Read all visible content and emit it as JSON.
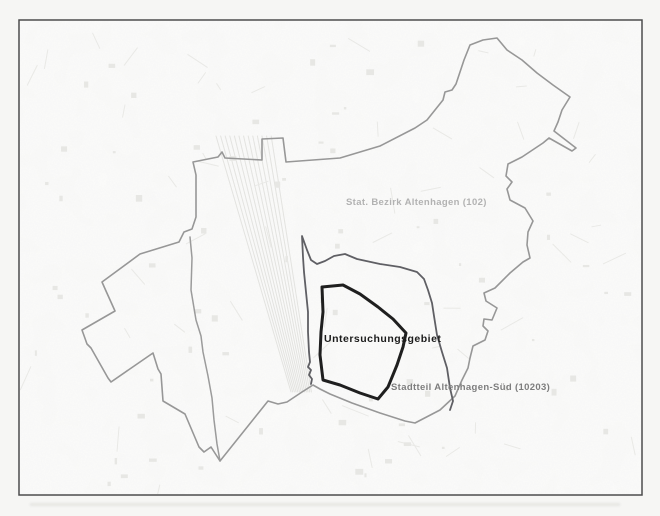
{
  "map": {
    "title": "Untersuchungsgebiet Altenhagen boundary map",
    "labels": {
      "bezirk": {
        "text": "Stat. Bezirk Altenhagen (102)",
        "color": "#b2b2b2"
      },
      "untersuchungsgebiet": {
        "text": "Untersuchungsgebiet",
        "color": "#1b1b1b"
      },
      "stadtteil": {
        "text": "Stadtteil Altenhagen-Süd (10203)",
        "color": "#7d7d7d"
      }
    },
    "frame": {
      "x": 19,
      "y": 20,
      "width": 623,
      "height": 475,
      "stroke": "#4c4c4c",
      "fill": "#fcfcfb"
    },
    "boundaries": [
      {
        "name": "boundary-stat-bezirk-altenhagen-102",
        "color": "#979797",
        "width": 1.6,
        "closed": true,
        "points": [
          [
            193,
            162
          ],
          [
            196,
            175
          ],
          [
            196,
            217
          ],
          [
            192,
            229
          ],
          [
            184,
            232
          ],
          [
            179,
            242
          ],
          [
            140,
            254
          ],
          [
            102,
            282
          ],
          [
            106,
            291
          ],
          [
            115,
            311
          ],
          [
            82,
            330
          ],
          [
            87,
            344
          ],
          [
            91,
            348
          ],
          [
            108,
            378
          ],
          [
            111,
            382
          ],
          [
            153,
            353
          ],
          [
            158,
            369
          ],
          [
            161,
            374
          ],
          [
            163,
            401
          ],
          [
            185,
            414
          ],
          [
            199,
            447
          ],
          [
            204,
            452
          ],
          [
            211,
            447
          ],
          [
            220,
            461
          ],
          [
            268,
            401
          ],
          [
            278,
            404
          ],
          [
            287,
            402
          ],
          [
            302,
            392
          ],
          [
            313,
            385
          ],
          [
            320,
            389
          ],
          [
            330,
            394
          ],
          [
            352,
            403
          ],
          [
            380,
            413
          ],
          [
            405,
            421
          ],
          [
            415,
            423
          ],
          [
            440,
            410
          ],
          [
            455,
            396
          ],
          [
            462,
            380
          ],
          [
            468,
            368
          ],
          [
            470,
            358
          ],
          [
            473,
            346
          ],
          [
            485,
            340
          ],
          [
            488,
            331
          ],
          [
            483,
            326
          ],
          [
            484,
            319
          ],
          [
            492,
            320
          ],
          [
            497,
            308
          ],
          [
            486,
            301
          ],
          [
            484,
            293
          ],
          [
            495,
            288
          ],
          [
            510,
            273
          ],
          [
            523,
            262
          ],
          [
            530,
            258
          ],
          [
            527,
            245
          ],
          [
            528,
            232
          ],
          [
            533,
            221
          ],
          [
            525,
            208
          ],
          [
            510,
            200
          ],
          [
            507,
            189
          ],
          [
            512,
            182
          ],
          [
            506,
            176
          ],
          [
            508,
            164
          ],
          [
            522,
            157
          ],
          [
            543,
            143
          ],
          [
            549,
            138
          ],
          [
            572,
            151
          ],
          [
            576,
            148
          ],
          [
            554,
            131
          ],
          [
            558,
            122
          ],
          [
            562,
            110
          ],
          [
            570,
            97
          ],
          [
            553,
            85
          ],
          [
            537,
            73
          ],
          [
            522,
            60
          ],
          [
            507,
            50
          ],
          [
            497,
            38
          ],
          [
            483,
            40
          ],
          [
            470,
            45
          ],
          [
            464,
            60
          ],
          [
            456,
            84
          ],
          [
            452,
            90
          ],
          [
            445,
            92
          ],
          [
            443,
            100
          ],
          [
            427,
            120
          ],
          [
            415,
            128
          ],
          [
            380,
            146
          ],
          [
            340,
            158
          ],
          [
            286,
            162
          ],
          [
            283,
            138
          ],
          [
            262,
            139
          ],
          [
            262,
            160
          ],
          [
            225,
            158
          ],
          [
            222,
            152
          ],
          [
            218,
            157
          ]
        ]
      },
      {
        "name": "boundary-bezirk-railway-edge",
        "color": "#9b9b9b",
        "width": 1.5,
        "closed": false,
        "points": [
          [
            190,
            237
          ],
          [
            192,
            258
          ],
          [
            191,
            290
          ],
          [
            196,
            320
          ],
          [
            201,
            336
          ],
          [
            203,
            352
          ],
          [
            208,
            376
          ],
          [
            212,
            398
          ],
          [
            214,
            420
          ],
          [
            217,
            444
          ],
          [
            220,
            461
          ]
        ]
      },
      {
        "name": "boundary-stadtteil-altenhagen-sued-10203",
        "color": "#5f5f64",
        "width": 1.8,
        "closed": false,
        "points": [
          [
            311,
            384
          ],
          [
            312,
            379
          ],
          [
            309,
            375
          ],
          [
            311,
            370
          ],
          [
            308,
            367
          ],
          [
            310,
            362
          ],
          [
            309,
            352
          ],
          [
            308,
            332
          ],
          [
            308,
            312
          ],
          [
            306,
            292
          ],
          [
            304,
            272
          ],
          [
            303,
            257
          ],
          [
            302,
            236
          ],
          [
            307,
            250
          ],
          [
            311,
            260
          ],
          [
            317,
            264
          ],
          [
            325,
            261
          ],
          [
            334,
            256
          ],
          [
            345,
            254
          ],
          [
            357,
            259
          ],
          [
            380,
            264
          ],
          [
            400,
            267
          ],
          [
            417,
            272
          ],
          [
            424,
            279
          ],
          [
            428,
            290
          ],
          [
            432,
            303
          ],
          [
            434,
            316
          ],
          [
            437,
            335
          ],
          [
            442,
            352
          ],
          [
            447,
            368
          ],
          [
            450,
            388
          ],
          [
            453,
            401
          ],
          [
            450,
            410
          ]
        ]
      },
      {
        "name": "boundary-untersuchungsgebiet",
        "color": "#1f1f1f",
        "width": 3,
        "closed": true,
        "points": [
          [
            322,
            287
          ],
          [
            343,
            285
          ],
          [
            360,
            294
          ],
          [
            378,
            307
          ],
          [
            393,
            319
          ],
          [
            406,
            333
          ],
          [
            403,
            347
          ],
          [
            397,
            365
          ],
          [
            388,
            387
          ],
          [
            378,
            399
          ],
          [
            360,
            393
          ],
          [
            340,
            385
          ],
          [
            323,
            380
          ],
          [
            320,
            355
          ],
          [
            321,
            332
          ],
          [
            323,
            312
          ]
        ]
      }
    ]
  }
}
